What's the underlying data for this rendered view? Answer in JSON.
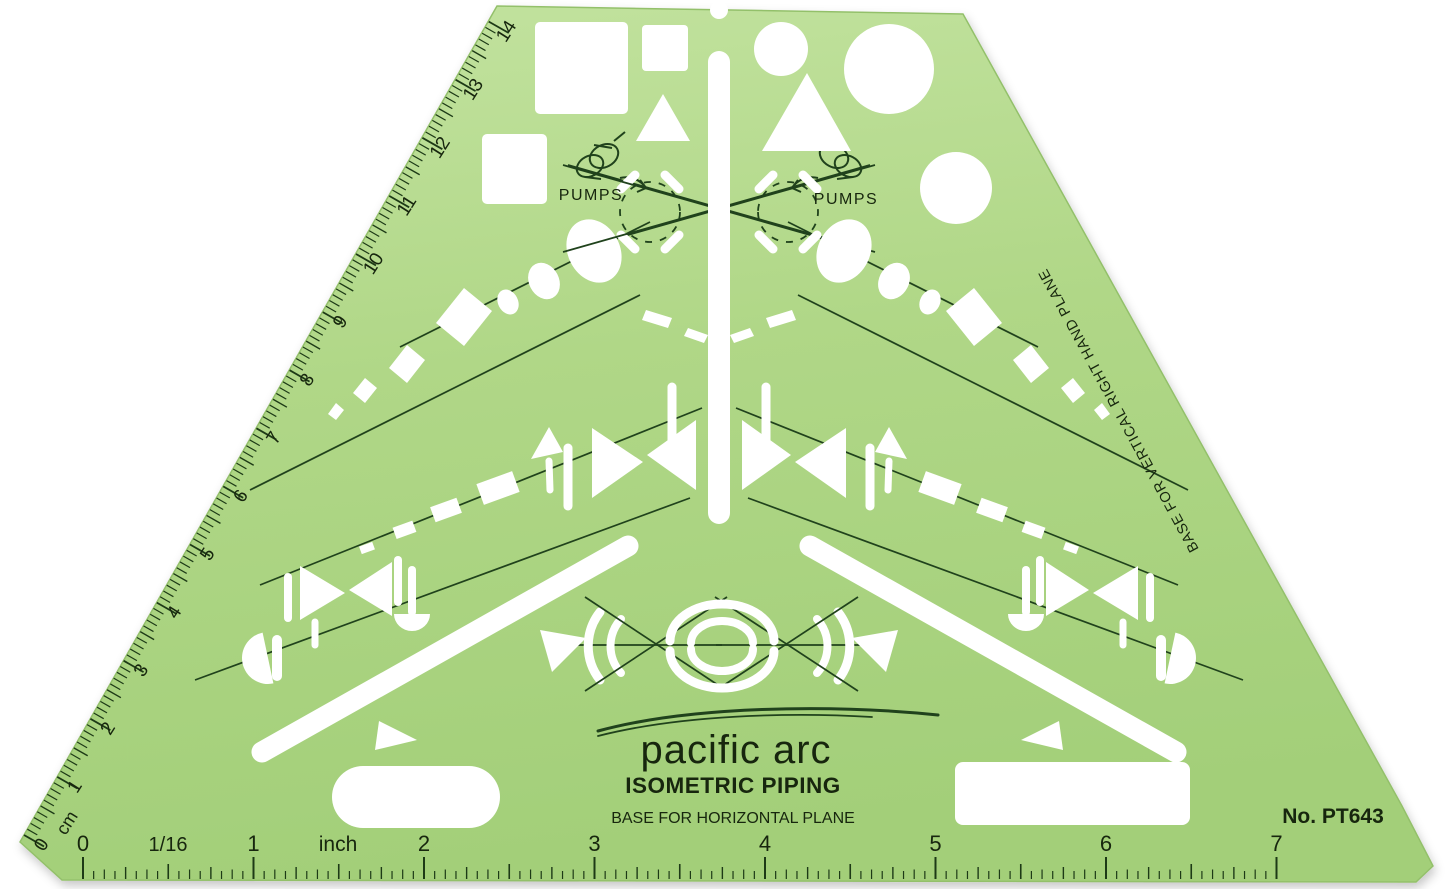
{
  "product": {
    "brand": "pacific arc",
    "title": "ISOMETRIC PIPING",
    "base_label": "BASE FOR HORIZONTAL PLANE",
    "model_number": "No. PT643",
    "vertical_edge_label": "BASE FOR VERTICAL RIGHT HAND PLANE",
    "pumps_left": "PUMPS",
    "pumps_right": "PUMPS"
  },
  "scales": {
    "cm": {
      "unit_label": "cm",
      "numbers": [
        "0",
        "1",
        "2",
        "3",
        "4",
        "5",
        "6",
        "7",
        "8",
        "9",
        "10",
        "11",
        "12",
        "13",
        "14"
      ]
    },
    "inch": {
      "unit_label": "inch",
      "sixteenth_label": "1/16",
      "numbers": [
        "0",
        "1",
        "2",
        "3",
        "4",
        "5",
        "6",
        "7"
      ]
    }
  },
  "colors": {
    "template_green": "#b0d787",
    "template_green_light": "#c3e3a0",
    "template_green_dark": "#a3cf79",
    "engraving": "#20421c",
    "ink": "#17260e",
    "tick": "#1d3a16",
    "cutout": "#ffffff",
    "background": "#ffffff"
  }
}
